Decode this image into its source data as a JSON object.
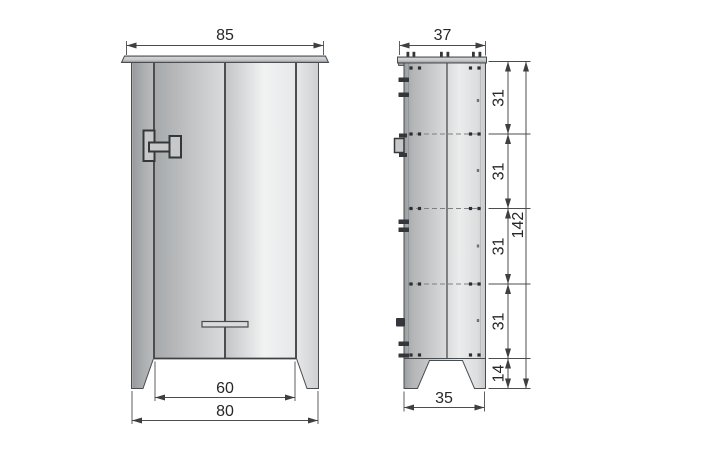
{
  "drawing": {
    "front": {
      "top_width": "85",
      "inner_base_width": "60",
      "base_width": "80"
    },
    "side": {
      "top_depth": "37",
      "base_depth": "35",
      "shelf_spacings": [
        "31",
        "31",
        "31",
        "31"
      ],
      "foot_height": "14",
      "total_height": "142"
    },
    "colors": {
      "dimension_line": "#4d4d4d",
      "dimension_text": "#272727",
      "panel_light": "#ebecec",
      "panel_mid": "#b2b4b6",
      "panel_dark": "#9b9ea1",
      "outline": "#4a4d50"
    }
  }
}
